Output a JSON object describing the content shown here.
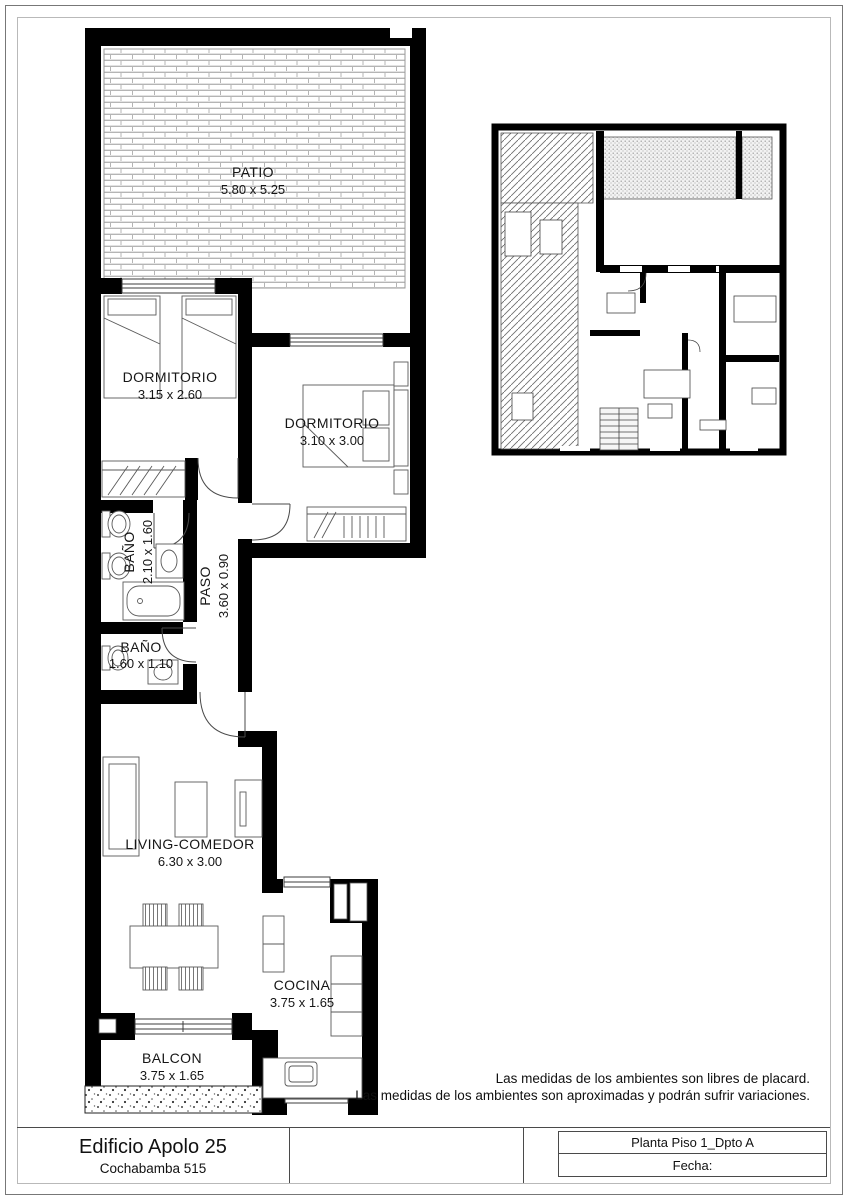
{
  "title_block": {
    "project_name": "Edificio Apolo 25",
    "address": "Cochabamba 515",
    "plan_title": "Planta Piso 1_Dpto A",
    "date_label": "Fecha:"
  },
  "notes": {
    "line1": "Las medidas de los ambientes son libres de placard.",
    "line2": "Las medidas de los ambientes son aproximadas y podrán sufrir variaciones."
  },
  "rooms": [
    {
      "name": "PATIO",
      "dims": "5.80 x 5.25"
    },
    {
      "name": "DORMITORIO",
      "dims": "3.15 x 2.60"
    },
    {
      "name": "DORMITORIO",
      "dims": "3.10 x 3.00"
    },
    {
      "name": "BAÑO",
      "dims": "2.10 x 1.60"
    },
    {
      "name": "PASO",
      "dims": "3.60 x 0.90"
    },
    {
      "name": "BAÑO",
      "dims": "1.60 x 1.10"
    },
    {
      "name": "LIVING-COMEDOR",
      "dims": "6.30 x 3.00"
    },
    {
      "name": "COCINA",
      "dims": "3.75 x 1.65"
    },
    {
      "name": "BALCON",
      "dims": "3.75 x 1.65"
    }
  ],
  "colors": {
    "wall": "#000000",
    "drawing_line": "#4a4a4a",
    "brick_joint": "#b5b5b5",
    "text": "#161616"
  }
}
